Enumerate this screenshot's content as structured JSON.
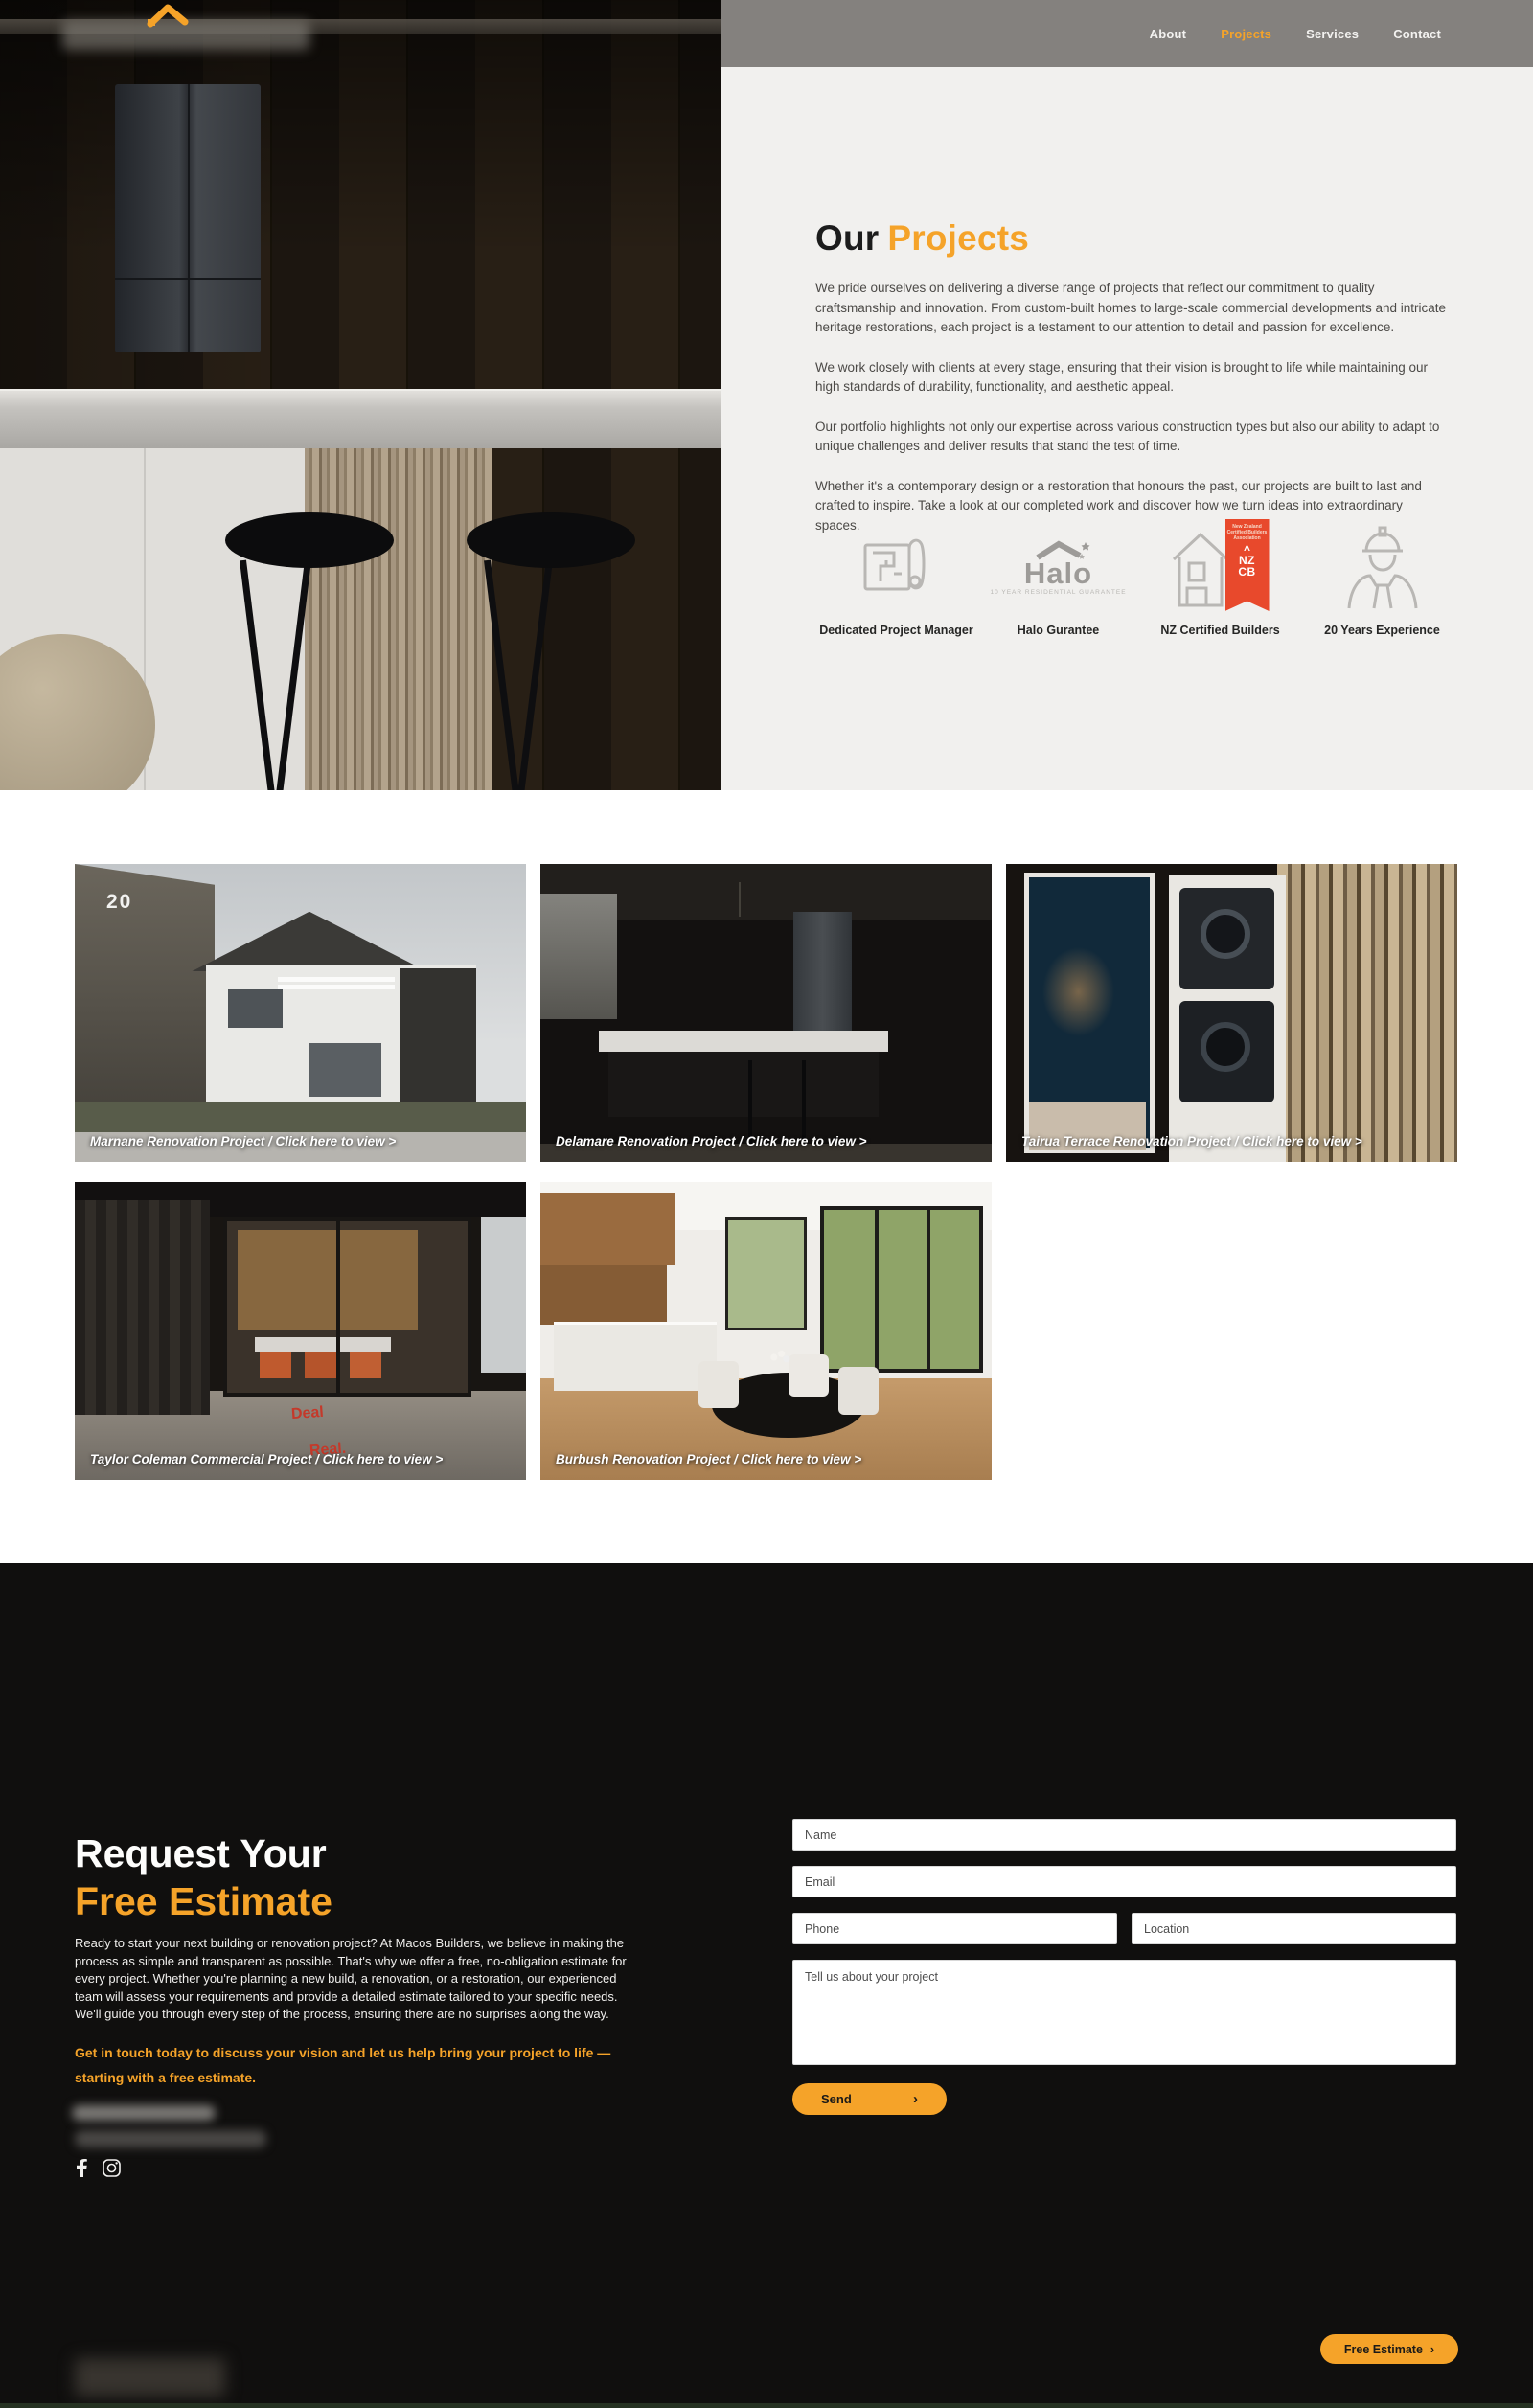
{
  "colors": {
    "accent": "#F5A329",
    "nav_bg": "#84817E",
    "light_bg": "#F1F0EE",
    "dark_bg": "#100F0E",
    "nzcb_red": "#E8492C"
  },
  "nav": {
    "items": [
      {
        "label": "About",
        "active": false
      },
      {
        "label": "Projects",
        "active": true
      },
      {
        "label": "Services",
        "active": false
      },
      {
        "label": "Contact",
        "active": false
      }
    ]
  },
  "intro": {
    "title_prefix": "Our",
    "title_accent": "Projects",
    "paragraphs": [
      "We pride ourselves on delivering a diverse range of projects that reflect our commitment to quality craftsmanship and innovation. From custom-built homes to large-scale commercial developments and intricate heritage restorations, each project is a testament to our attention to detail and passion for excellence.",
      "We work closely with clients at every stage, ensuring that their vision is brought to life while maintaining our high standards of durability, functionality, and aesthetic appeal.",
      "Our portfolio highlights not only our expertise across various construction types but also our ability to adapt to unique challenges and deliver results that stand the test of time.",
      "Whether it's a contemporary design or a restoration that honours the past, our projects are built to last and crafted to inspire. Take a look at our completed work and discover how we turn ideas into extraordinary spaces."
    ],
    "features": [
      {
        "icon": "blueprint-icon",
        "label": "Dedicated Project Manager"
      },
      {
        "icon": "halo-logo",
        "label": "Halo Gurantee",
        "logo_word": "Halo",
        "logo_sub": "10 YEAR RESIDENTIAL GUARANTEE"
      },
      {
        "icon": "nzcb-badge-icon",
        "label": "NZ Certified Builders",
        "badge_small_text": "New Zealand Certified Builders Association",
        "badge_chevron": "^",
        "badge_code_line1": "NZ",
        "badge_code_line2": "CB"
      },
      {
        "icon": "builder-icon",
        "label": "20 Years Experience"
      }
    ]
  },
  "projects": [
    {
      "caption": "Marnane Renovation Project / Click here to view >",
      "photo_text": "20"
    },
    {
      "caption": "Delamare Renovation Project / Click here to view >"
    },
    {
      "caption": "Tairua Terrace Renovation Project / Click here to view >"
    },
    {
      "caption": "Taylor Coleman Commercial Project / Click here to view >",
      "decal_line1": "Deal",
      "decal_line2": "Real."
    },
    {
      "caption": "Burbush Renovation Project / Click here to view >"
    }
  ],
  "estimate": {
    "title_line1": "Request Your",
    "title_line2": "Free Estimate",
    "body": "Ready to start your next building or renovation project? At Macos Builders, we believe in making the process as simple and transparent as possible. That's why we offer a free, no-obligation estimate for every project. Whether you're planning a new build, a renovation, or a restoration, our experienced team will assess your requirements and provide a detailed estimate tailored to your specific needs. We'll guide you through every step of the process, ensuring there are no surprises along the way.",
    "cta_text": "Get in touch today to discuss your vision and let us help bring your project to life — starting with a free estimate.",
    "form": {
      "name_placeholder": "Name",
      "email_placeholder": "Email",
      "phone_placeholder": "Phone",
      "location_placeholder": "Location",
      "message_placeholder": "Tell us about your project",
      "send_label": "Send",
      "send_arrow": "›"
    }
  },
  "floating_button": {
    "label": "Free Estimate",
    "arrow": "›"
  }
}
